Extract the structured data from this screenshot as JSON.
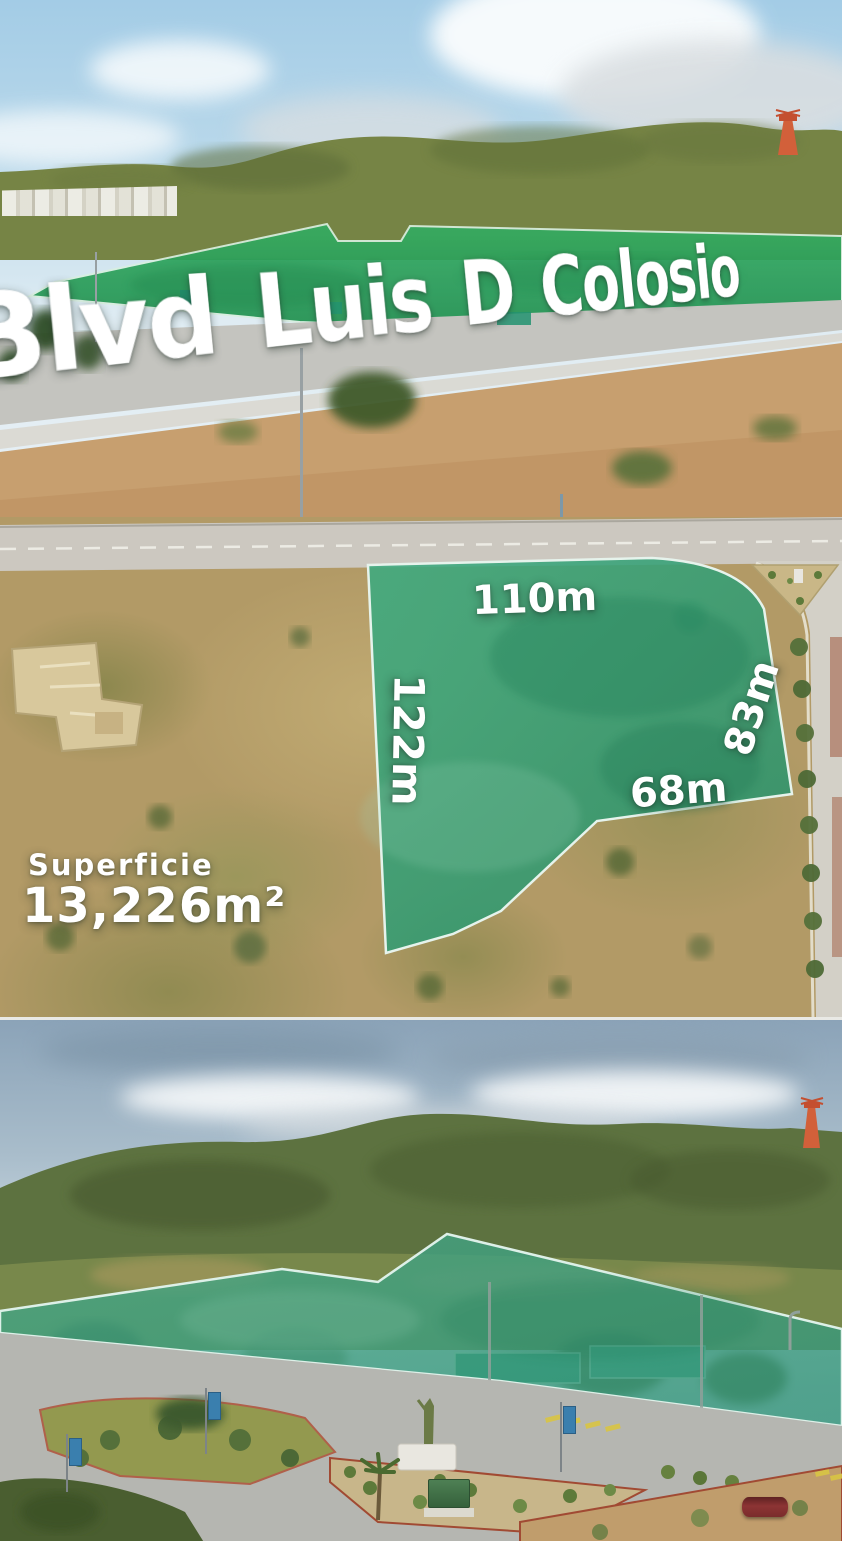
{
  "title": {
    "text": "Blvd Luis D Colosio"
  },
  "lot": {
    "measure_top": "110m",
    "measure_left": "122m",
    "measure_right": "83m",
    "measure_bottom": "68m",
    "area_label": "Superficie",
    "area_value": "13,226m²"
  },
  "colors": {
    "overlay_green_photo1": "#2aa25c",
    "overlay_teal_photo2": "#2f9e77",
    "overlay_teal_photo3": "#3fa182",
    "text": "#ffffff"
  }
}
